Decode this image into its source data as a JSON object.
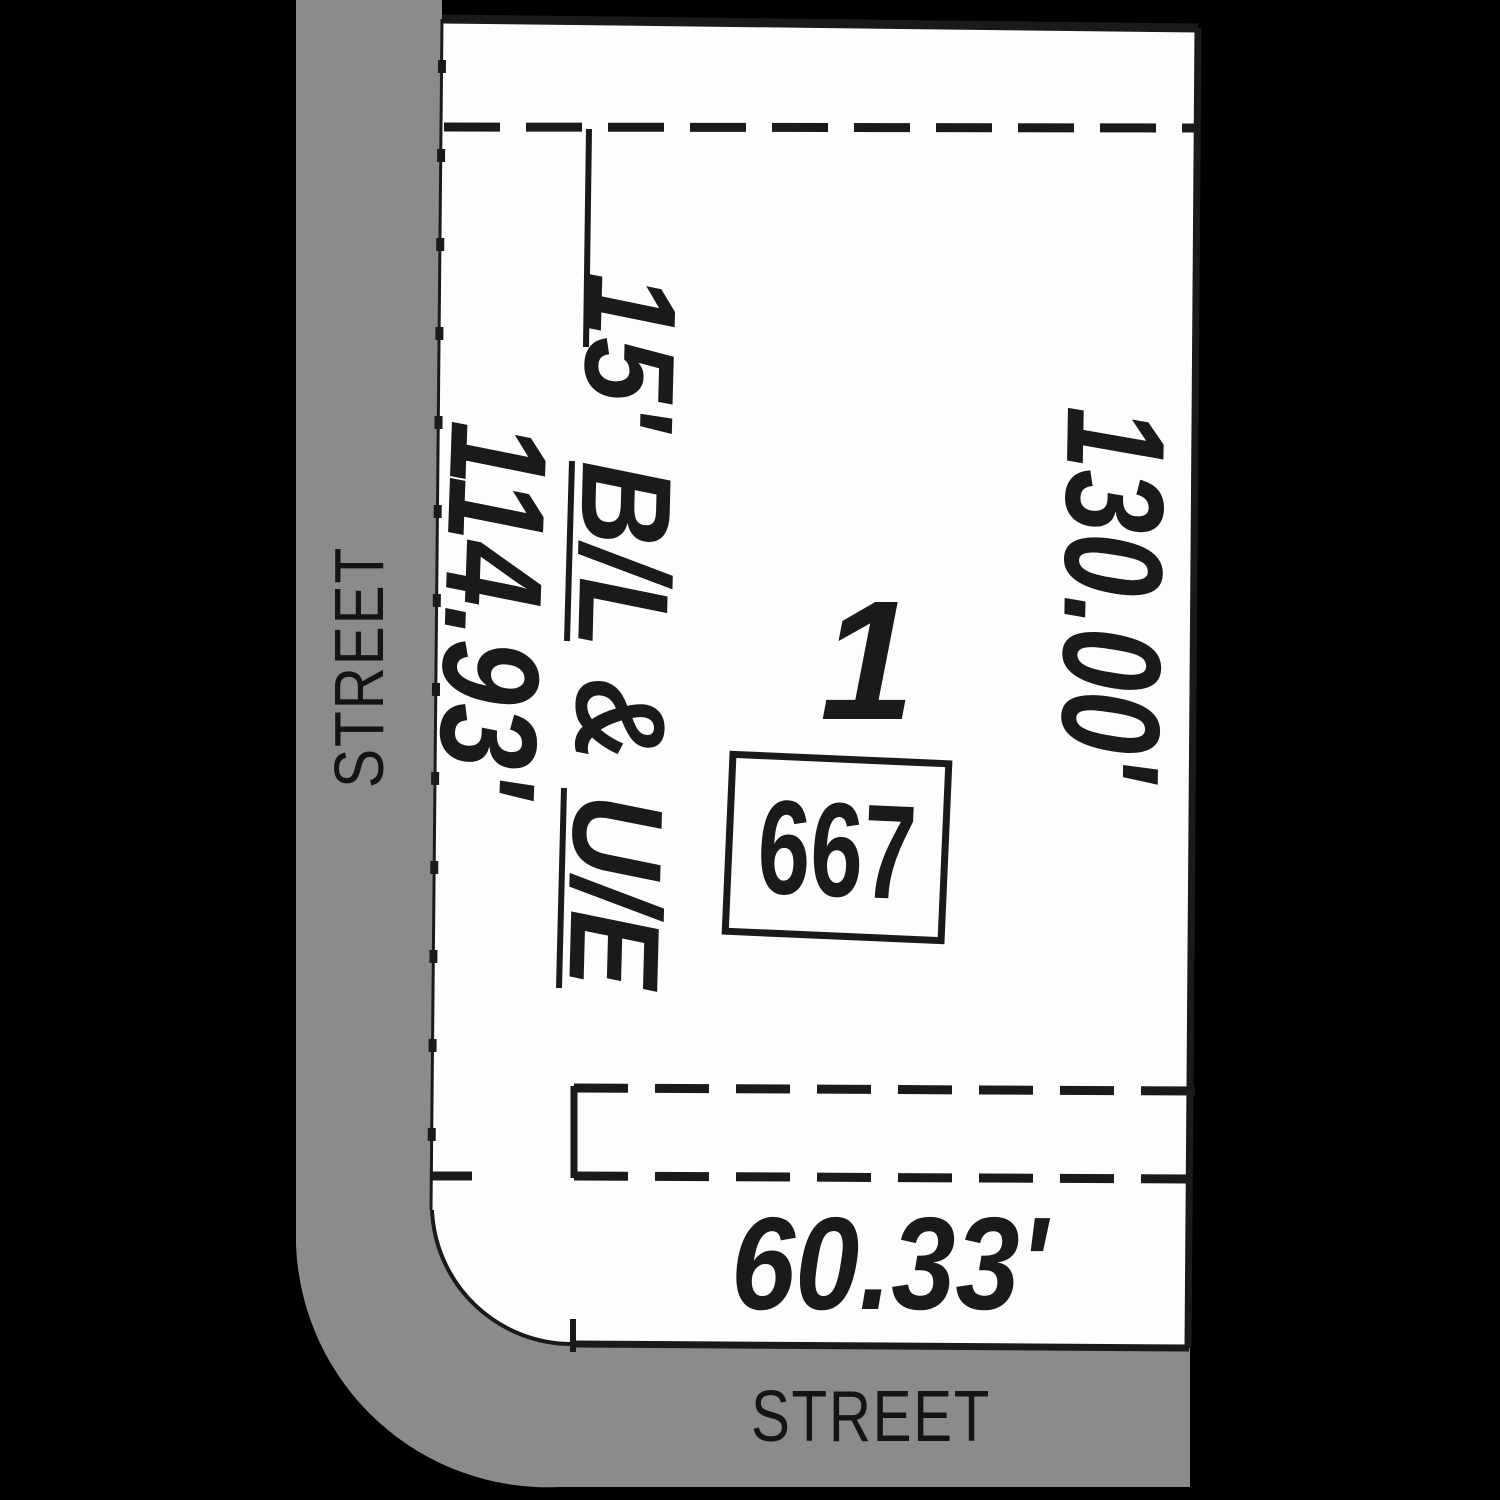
{
  "map": {
    "street_left": {
      "label": "STREET"
    },
    "street_bottom": {
      "label": "STREET"
    },
    "lot": {
      "number": "1",
      "address": "667",
      "front_dimension": "60.33'",
      "side_left_dimension": "114.93'",
      "side_right_dimension": "130.00'",
      "building_line_label": "15' B/L & U/E"
    },
    "colors": {
      "background": "#000000",
      "street_fill": "#8b8b8b",
      "lot_fill": "#fdfdfd",
      "line": "#1a1a1a",
      "text": "#1a1a1a",
      "street_text": "#141414"
    }
  }
}
